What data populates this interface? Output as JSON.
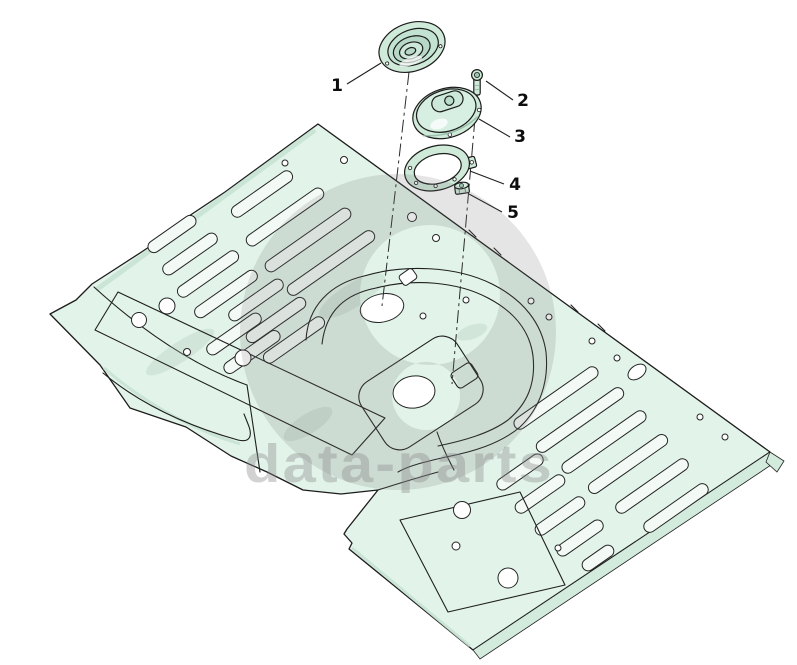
{
  "diagram": {
    "type": "exploded-parts-diagram",
    "background": "#ffffff",
    "callouts": [
      {
        "label": "1"
      },
      {
        "label": "2"
      },
      {
        "label": "3"
      },
      {
        "label": "4"
      },
      {
        "label": "5"
      }
    ],
    "watermark": {
      "text": "data-parts",
      "text_color": "#8a8a8a",
      "logo_color": "#6e6e6e"
    },
    "colors": {
      "panel_fill": "#e2f4ea",
      "panel_shade": "#cde8d9",
      "part_fill": "#cfead9",
      "slot_fill": "#f3faf6",
      "outline": "#1c1c1c"
    }
  }
}
